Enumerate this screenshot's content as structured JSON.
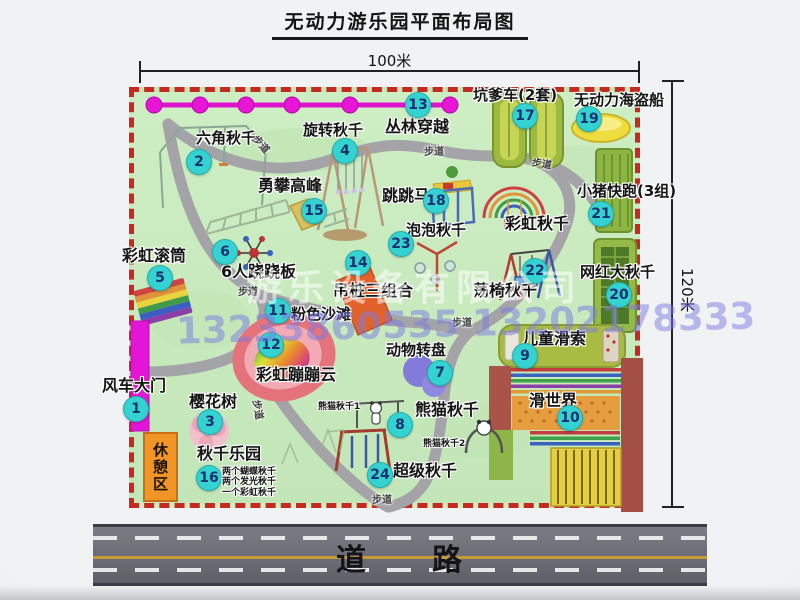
{
  "title": "无动力游乐园平面布局图",
  "dimensions": {
    "width": "100米",
    "height": "120米"
  },
  "road_label": "道　　路",
  "rest_area_label": "休憩区",
  "watermark": {
    "company": "游乐设备有限公司",
    "phone": "13233860535 13202178333"
  },
  "colors": {
    "badge": "#35d2d2",
    "badge_text": "#1d3070",
    "map_green": "#c9eabe",
    "border_red": "#c62a1e",
    "gate_magenta": "#e315d6",
    "road_gray": "#6b6b74",
    "rest_orange": "#f09526"
  },
  "attractions": [
    {
      "num": "1",
      "label": "风车大门",
      "badge": [
        136,
        409
      ],
      "text": [
        102,
        378
      ],
      "size": 16
    },
    {
      "num": "2",
      "label": "六角秋千",
      "badge": [
        199,
        162
      ],
      "text": [
        196,
        131
      ],
      "size": 15
    },
    {
      "num": "3",
      "label": "樱花树",
      "badge": [
        210,
        422
      ],
      "text": [
        189,
        394
      ],
      "size": 16
    },
    {
      "num": "4",
      "label": "旋转秋千",
      "badge": [
        345,
        151
      ],
      "text": [
        303,
        123
      ],
      "size": 15
    },
    {
      "num": "5",
      "label": "彩虹滚筒",
      "badge": [
        160,
        278
      ],
      "text": [
        122,
        248
      ],
      "size": 16
    },
    {
      "num": "6",
      "label": "6人跷跷板",
      "badge": [
        225,
        252
      ],
      "text": [
        221,
        264
      ],
      "size": 16
    },
    {
      "num": "7",
      "label": "动物转盘",
      "badge": [
        440,
        373
      ],
      "text": [
        386,
        343
      ],
      "size": 15
    },
    {
      "num": "8",
      "label": "熊猫秋千",
      "badge": [
        400,
        425
      ],
      "text": [
        415,
        402
      ],
      "size": 16
    },
    {
      "num": "9",
      "label": "儿童滑索",
      "badge": [
        525,
        356
      ],
      "text": [
        522,
        331
      ],
      "size": 16
    },
    {
      "num": "10",
      "label": "滑世界",
      "badge": [
        570,
        418
      ],
      "text": [
        529,
        393
      ],
      "size": 16
    },
    {
      "num": "11",
      "label": "粉色沙滩",
      "badge": [
        278,
        311
      ],
      "text": [
        291,
        307
      ],
      "size": 15
    },
    {
      "num": "12",
      "label": "彩虹蹦蹦云",
      "badge": [
        271,
        345
      ],
      "text": [
        256,
        367
      ],
      "size": 16
    },
    {
      "num": "13",
      "label": "丛林穿越",
      "badge": [
        418,
        105
      ],
      "text": [
        385,
        119
      ],
      "size": 16
    },
    {
      "num": "14",
      "label": "吊桩三组合",
      "badge": [
        358,
        263
      ],
      "text": [
        333,
        283
      ],
      "size": 16
    },
    {
      "num": "15",
      "label": "勇攀高峰",
      "badge": [
        314,
        211
      ],
      "text": [
        258,
        178
      ],
      "size": 16
    },
    {
      "num": "16",
      "label": "秋千乐园",
      "badge": [
        209,
        478
      ],
      "text": [
        197,
        446
      ],
      "size": 16
    },
    {
      "num": "17",
      "label": "坑爹车(2套)",
      "badge": [
        525,
        116
      ],
      "text": [
        473,
        88
      ],
      "size": 15
    },
    {
      "num": "18",
      "label": "跳跳马",
      "badge": [
        436,
        201
      ],
      "text": [
        382,
        188
      ],
      "size": 16
    },
    {
      "num": "19",
      "label": "无动力海盗船",
      "badge": [
        589,
        119
      ],
      "text": [
        574,
        93
      ],
      "size": 15
    },
    {
      "num": "20",
      "label": "网红大秋千",
      "badge": [
        619,
        295
      ],
      "text": [
        580,
        265
      ],
      "size": 15
    },
    {
      "num": "21",
      "label": "小猪快跑(3组)",
      "badge": [
        601,
        214
      ],
      "text": [
        577,
        184
      ],
      "size": 15
    },
    {
      "num": "22",
      "label": "荡椅秋千",
      "badge": [
        535,
        271
      ],
      "text": [
        473,
        283
      ],
      "size": 16
    },
    {
      "num": "23",
      "label": "泡泡秋千",
      "badge": [
        401,
        244
      ],
      "text": [
        406,
        223
      ],
      "size": 15
    },
    {
      "num": "24",
      "label": "超级秋千",
      "badge": [
        380,
        475
      ],
      "text": [
        393,
        463
      ],
      "size": 16
    }
  ],
  "sub_labels": [
    {
      "text": "彩虹秋千",
      "x": 505,
      "y": 216,
      "size": 16
    },
    {
      "text": "熊猫秋千1",
      "x": 318,
      "y": 403,
      "size": 9
    },
    {
      "text": "熊猫秋千2",
      "x": 423,
      "y": 440,
      "size": 9
    },
    {
      "text": "两个蝴蝶秋千",
      "x": 222,
      "y": 468,
      "size": 9
    },
    {
      "text": "两个发光秋千",
      "x": 222,
      "y": 478,
      "size": 9
    },
    {
      "text": "一个彩虹秋千",
      "x": 222,
      "y": 489,
      "size": 9
    }
  ],
  "walkway_labels": [
    {
      "text": "步道",
      "x": 252,
      "y": 136,
      "rot": 48
    },
    {
      "text": "步道",
      "x": 424,
      "y": 143,
      "rot": 0
    },
    {
      "text": "步道",
      "x": 532,
      "y": 155,
      "rot": 10
    },
    {
      "text": "步道",
      "x": 238,
      "y": 283,
      "rot": 0
    },
    {
      "text": "步道",
      "x": 452,
      "y": 314,
      "rot": 0
    },
    {
      "text": "步道",
      "x": 372,
      "y": 491,
      "rot": 0
    },
    {
      "text": "步道",
      "x": 249,
      "y": 402,
      "rot": 80
    }
  ]
}
